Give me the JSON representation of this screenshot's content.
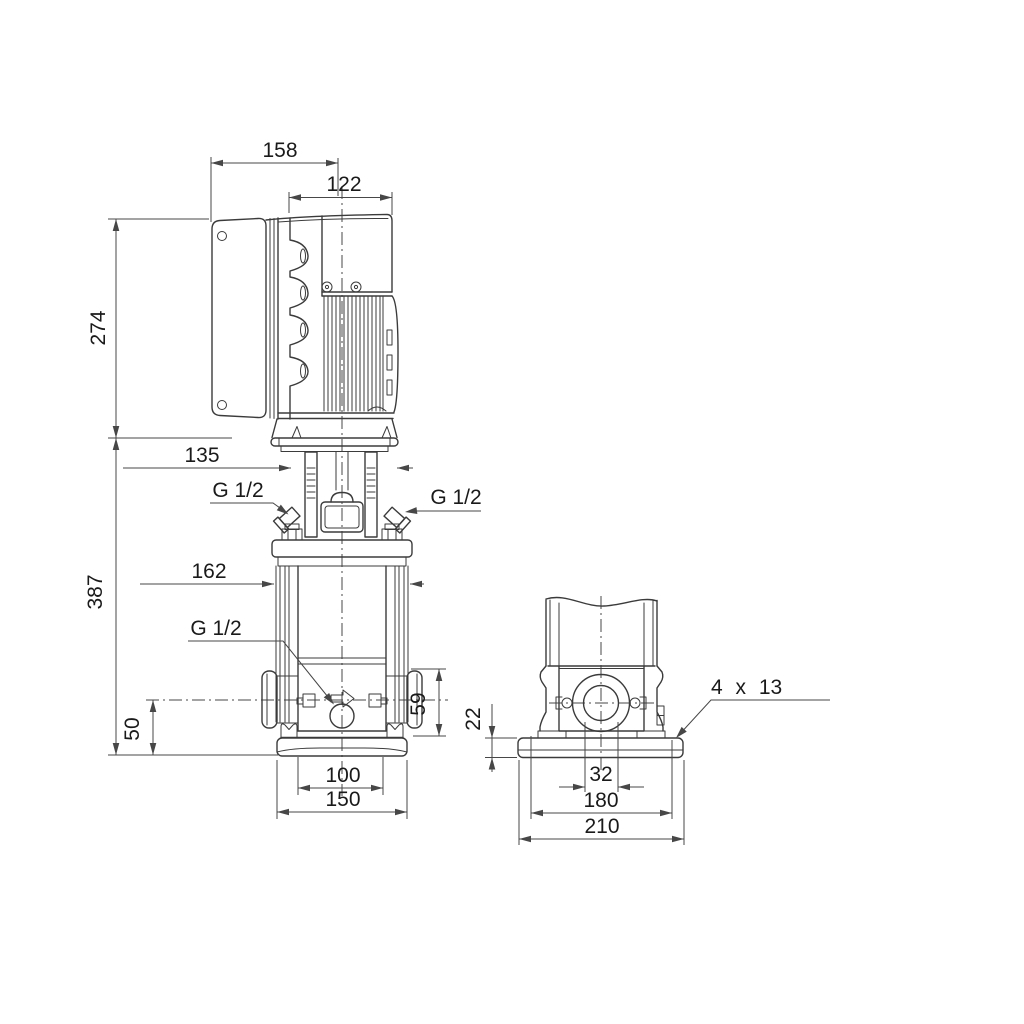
{
  "drawing": {
    "kind": "pump-dimensional-drawing",
    "views": [
      "side-view",
      "front-view"
    ]
  },
  "colors": {
    "line": "#3b3b3b",
    "dim": "#474747",
    "text": "#1a1a1a",
    "background": "#ffffff"
  },
  "side_view": {
    "overall_width": "158",
    "motor_width": "122",
    "motor_height": "274",
    "clamp_width": "135",
    "pump_height": "387",
    "chamber_width": "162",
    "gauge_port_left": "G 1/2",
    "gauge_port_right": "G 1/2",
    "drain_port": "G 1/2",
    "drain_height": "50",
    "port_height": "59",
    "foot_hole_spacing": "100",
    "base_depth": "150"
  },
  "front_view": {
    "base_height": "22",
    "port_offset": "32",
    "bolt_hole_spacing": "180",
    "base_width": "210",
    "mounting_holes": "4 x 13"
  }
}
